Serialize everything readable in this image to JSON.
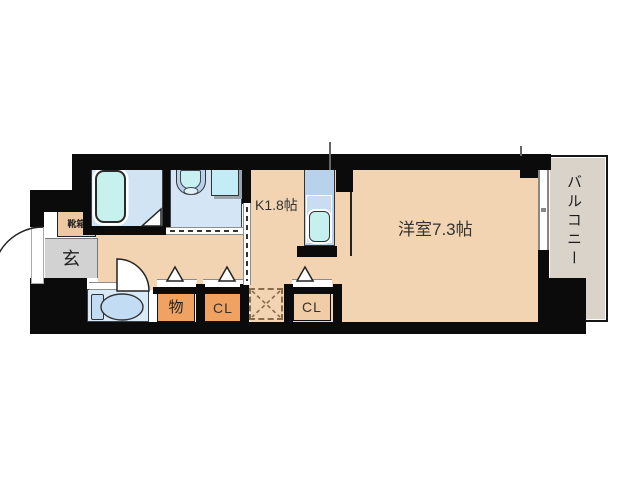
{
  "floorplan": {
    "rooms": {
      "shoe_cabinet_label": "靴箱",
      "entrance_label": "玄",
      "kitchen_label": "K1.8帖",
      "main_room_label": "洋室7.3帖",
      "balcony_label": "バルコニー",
      "storage_label": "物",
      "closet_hall_label": "CL",
      "closet_room_label": "CL"
    },
    "colors": {
      "floor_peach": "#f2d4b2",
      "wet_area_blue": "#d4e6f5",
      "fixture_cyan": "#c7f1ed",
      "kitchen_unit_blue": "#b9d2ec",
      "closet_orange": "#f0a263",
      "closet_tan": "#f0cda6",
      "shoe_cabinet_tan": "#eec8a2",
      "entrance_gray": "#d2d2d2",
      "balcony_gray": "#d9d3ca",
      "wall_black": "#0b0b0b"
    }
  }
}
